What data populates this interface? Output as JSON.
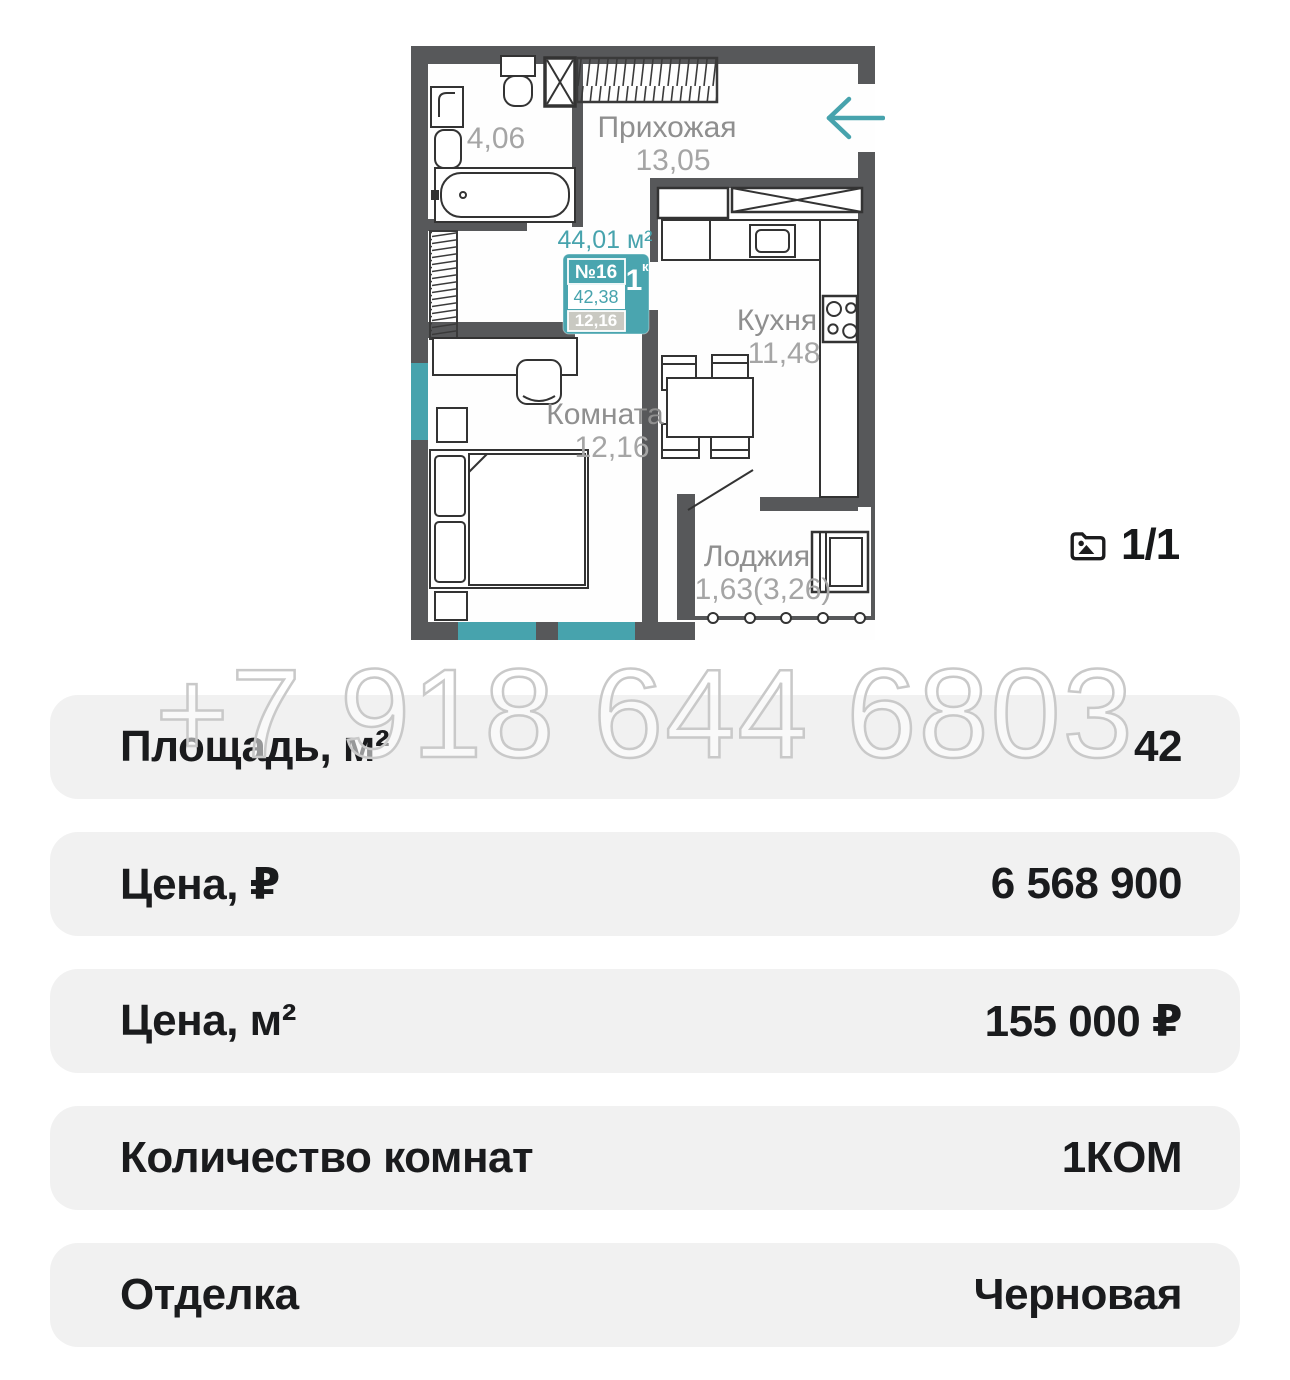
{
  "floorplan": {
    "rooms": {
      "hallway": {
        "name": "Прихожая",
        "area": "13,05"
      },
      "bathroom": {
        "area": "4,06"
      },
      "kitchen": {
        "name": "Кухня",
        "area": "11,48"
      },
      "room": {
        "name": "Комната",
        "area": "12,16"
      },
      "loggia": {
        "name": "Лоджия",
        "area": "1,63(3,26)"
      }
    },
    "unit": {
      "total_area": "44,01 м²",
      "number": "№16",
      "rooms_count": "1",
      "rooms_count_suffix": "к",
      "living_area": "42,38",
      "room_area": "12,16"
    },
    "colors": {
      "accent": "#47a3ad",
      "wall": "#57585a"
    }
  },
  "gallery": {
    "counter": "1/1",
    "icon": "image-folder-icon"
  },
  "watermark": {
    "phone": "+7 918 644 6803"
  },
  "details": {
    "rows": [
      {
        "label": "Площадь, м²",
        "value": "42"
      },
      {
        "label": "Цена, ₽",
        "value": "6 568 900"
      },
      {
        "label": "Цена, м²",
        "value": "155 000 ₽"
      },
      {
        "label": "Количество комнат",
        "value": "1КОМ"
      },
      {
        "label": "Отделка",
        "value": "Черновая"
      }
    ]
  }
}
